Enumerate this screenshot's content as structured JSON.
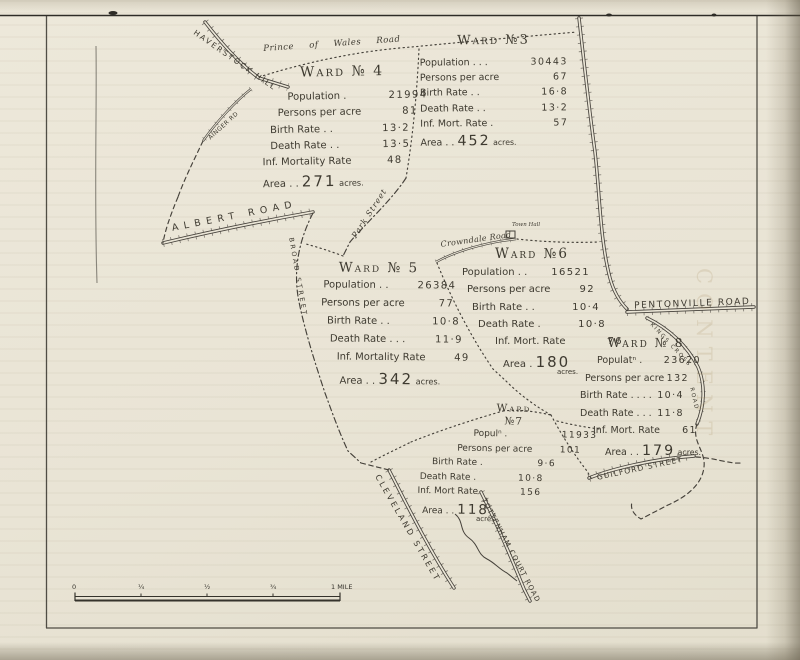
{
  "wards": [
    {
      "id": "ward-3",
      "title": "Ward №3",
      "rows": [
        {
          "label": "Population . . .",
          "value": "30443"
        },
        {
          "label": "Persons per acre",
          "value": "67"
        },
        {
          "label": "Birth Rate . .",
          "value": "16·8"
        },
        {
          "label": "Death Rate . .",
          "value": "13·2"
        },
        {
          "label": "Inf. Mort. Rate .",
          "value": "57"
        }
      ],
      "area": {
        "prefix": "Area . .",
        "number": "452",
        "suffix": "acres.",
        "stacked": false
      }
    },
    {
      "id": "ward-4",
      "title": "Ward № 4",
      "rows": [
        {
          "label": "Population .",
          "value": "21994"
        },
        {
          "label": "Persons per acre",
          "value": "81"
        },
        {
          "label": "Birth Rate . .",
          "value": "13·2"
        },
        {
          "label": "Death Rate . .",
          "value": "13·5"
        },
        {
          "label": "Inf. Mortality Rate",
          "value": "48"
        }
      ],
      "area": {
        "prefix": "Area . .",
        "number": "271",
        "suffix": "acres.",
        "stacked": false
      }
    },
    {
      "id": "ward-5",
      "title": "Ward № 5",
      "rows": [
        {
          "label": "Population . .",
          "value": "26384"
        },
        {
          "label": "Persons per acre",
          "value": "77"
        },
        {
          "label": "Birth Rate . .",
          "value": "10·8"
        },
        {
          "label": "Death Rate . . .",
          "value": "11·9"
        },
        {
          "label": "Inf. Mortality Rate",
          "value": "49"
        }
      ],
      "area": {
        "prefix": "Area . .",
        "number": "342",
        "suffix": "acres.",
        "stacked": false
      }
    },
    {
      "id": "ward-6",
      "title": "Ward №6",
      "rows": [
        {
          "label": "Population . .",
          "value": "16521"
        },
        {
          "label": "Persons per acre",
          "value": "92"
        },
        {
          "label": "Birth Rate . .",
          "value": "10·4"
        },
        {
          "label": "Death Rate .",
          "value": "10·8"
        },
        {
          "label": "Inf. Mort. Rate",
          "value": "76"
        }
      ],
      "area": {
        "prefix": "Area .",
        "number": "180",
        "suffix": "acres.",
        "stacked": true
      }
    },
    {
      "id": "ward-7",
      "title": "Ward",
      "title2": "№7",
      "rows": [
        {
          "label": "Populⁿ .",
          "value": "11933"
        },
        {
          "label": "Persons per acre",
          "value": "101"
        },
        {
          "label": "Birth Rate .",
          "value": "9·6"
        },
        {
          "label": "Death Rate .",
          "value": "10·8"
        },
        {
          "label": "Inf. Mort Rate",
          "value": "156"
        }
      ],
      "area": {
        "prefix": "Area . .",
        "number": "118",
        "suffix": "acres",
        "stacked": true
      }
    },
    {
      "id": "ward-8",
      "title": "Ward № 8",
      "rows": [
        {
          "label": "Populatⁿ .",
          "value": "23620"
        },
        {
          "label": "Persons per acre",
          "value": "132"
        },
        {
          "label": "Birth Rate . . . .",
          "value": "10·4"
        },
        {
          "label": "Death Rate . . .",
          "value": "11·8"
        },
        {
          "label": "Inf. Mort. Rate",
          "value": "61"
        }
      ],
      "area": {
        "prefix": "Area . .",
        "number": "179",
        "suffix": "acres.",
        "stacked": false
      }
    }
  ],
  "roads": [
    {
      "id": "haverstock-hill",
      "label": "HAVERSTOCK HILL"
    },
    {
      "id": "prince-of-wales-road",
      "label": "Prince of Wales Road"
    },
    {
      "id": "ainger-road",
      "label": "AINGER RD"
    },
    {
      "id": "albert-road",
      "label": "ALBERT ROAD"
    },
    {
      "id": "park-street",
      "label": "Park Street"
    },
    {
      "id": "crowndale-road",
      "label": "Crowndale Road"
    },
    {
      "id": "broad-street",
      "label": "BROAD STREET"
    },
    {
      "id": "pentonville-road",
      "label": "PENTONVILLE ROAD"
    },
    {
      "id": "kings-cross-road",
      "label": "KINGS CROSS"
    },
    {
      "id": "kings-cross-road-2",
      "label": "ROAD"
    },
    {
      "id": "guilford-street",
      "label": "GUILFORD STREET"
    },
    {
      "id": "cleveland-street",
      "label": "CLEVELAND STREET"
    },
    {
      "id": "tottenham-court-road",
      "label": "TOTTENHAM COURT ROAD"
    }
  ],
  "landmarks": [
    {
      "id": "town-hall",
      "label": "Town Hall"
    }
  ],
  "scale_bar": {
    "labels": [
      "0",
      "¼",
      "½",
      "¾",
      "1 MILE"
    ]
  },
  "ghost": {
    "text": "CONTENT"
  },
  "colors": {
    "ink": "#403c33",
    "paper": "#eae5d6",
    "scan_background": "#b6b0a1"
  }
}
